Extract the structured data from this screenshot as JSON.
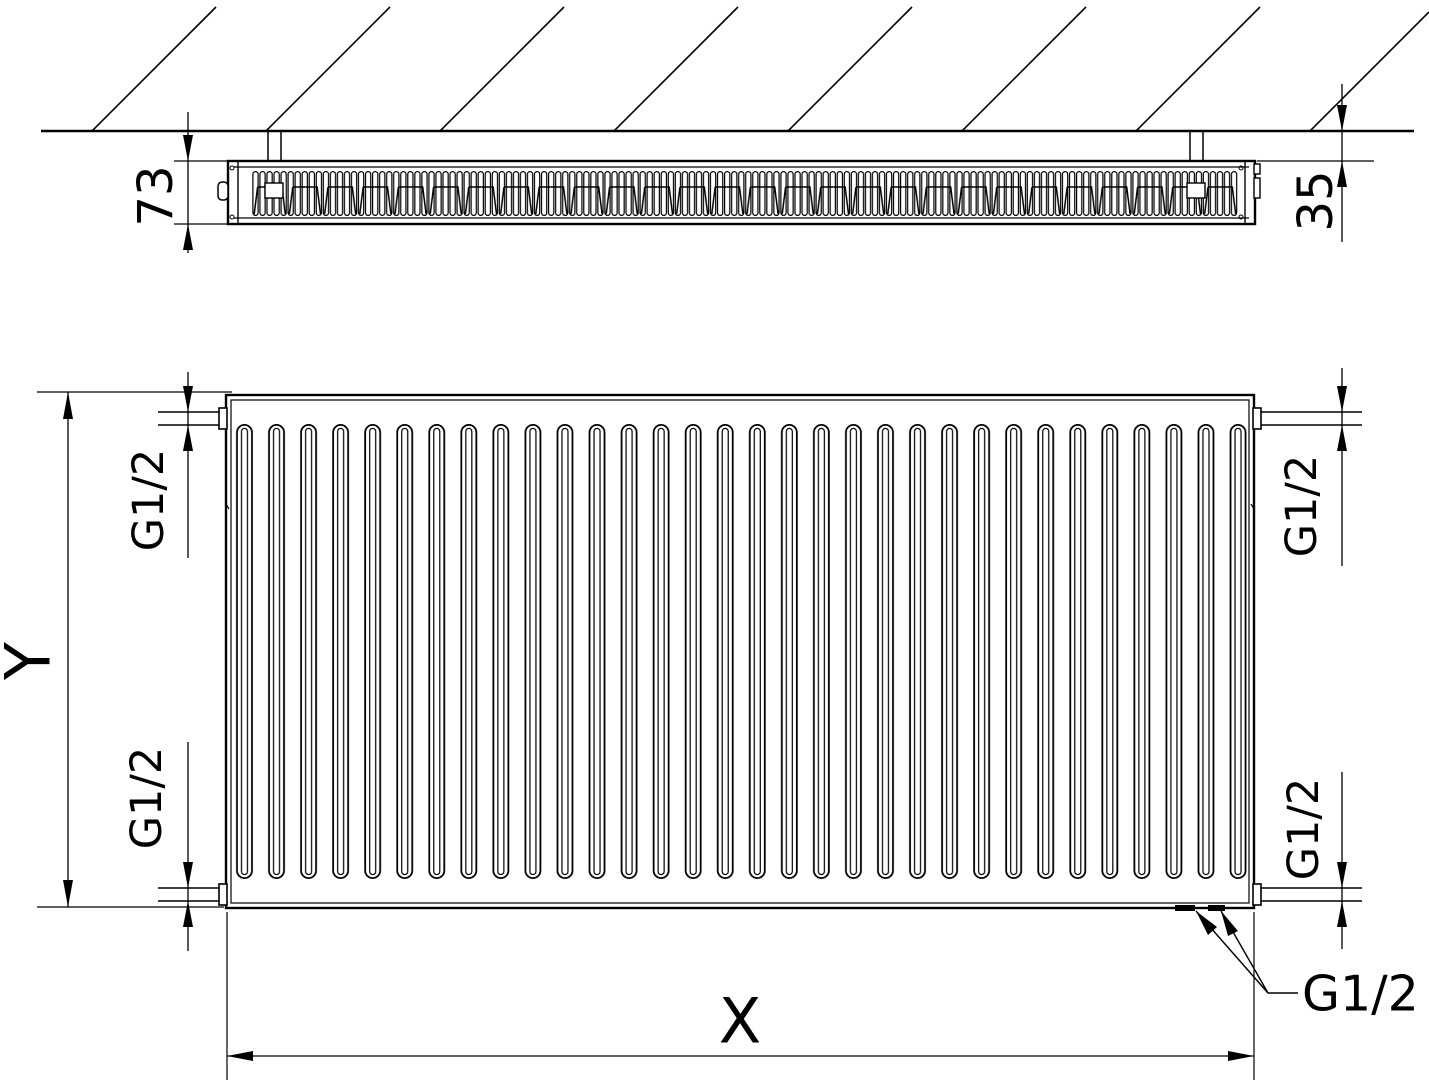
{
  "drawing_type": "radiator-technical-dimension-drawing",
  "views": {
    "top": {
      "depth_dim": "73",
      "wall_distance_dim": "35"
    },
    "front": {
      "height_dim": "Y",
      "width_dim": "X",
      "conn_top_left": "G1/2",
      "conn_bottom_left": "G1/2",
      "conn_top_right": "G1/2",
      "conn_bottom_right": "G1/2",
      "conn_bottom": "G1/2"
    }
  },
  "colors": {
    "line": "#000000",
    "background": "#ffffff"
  }
}
